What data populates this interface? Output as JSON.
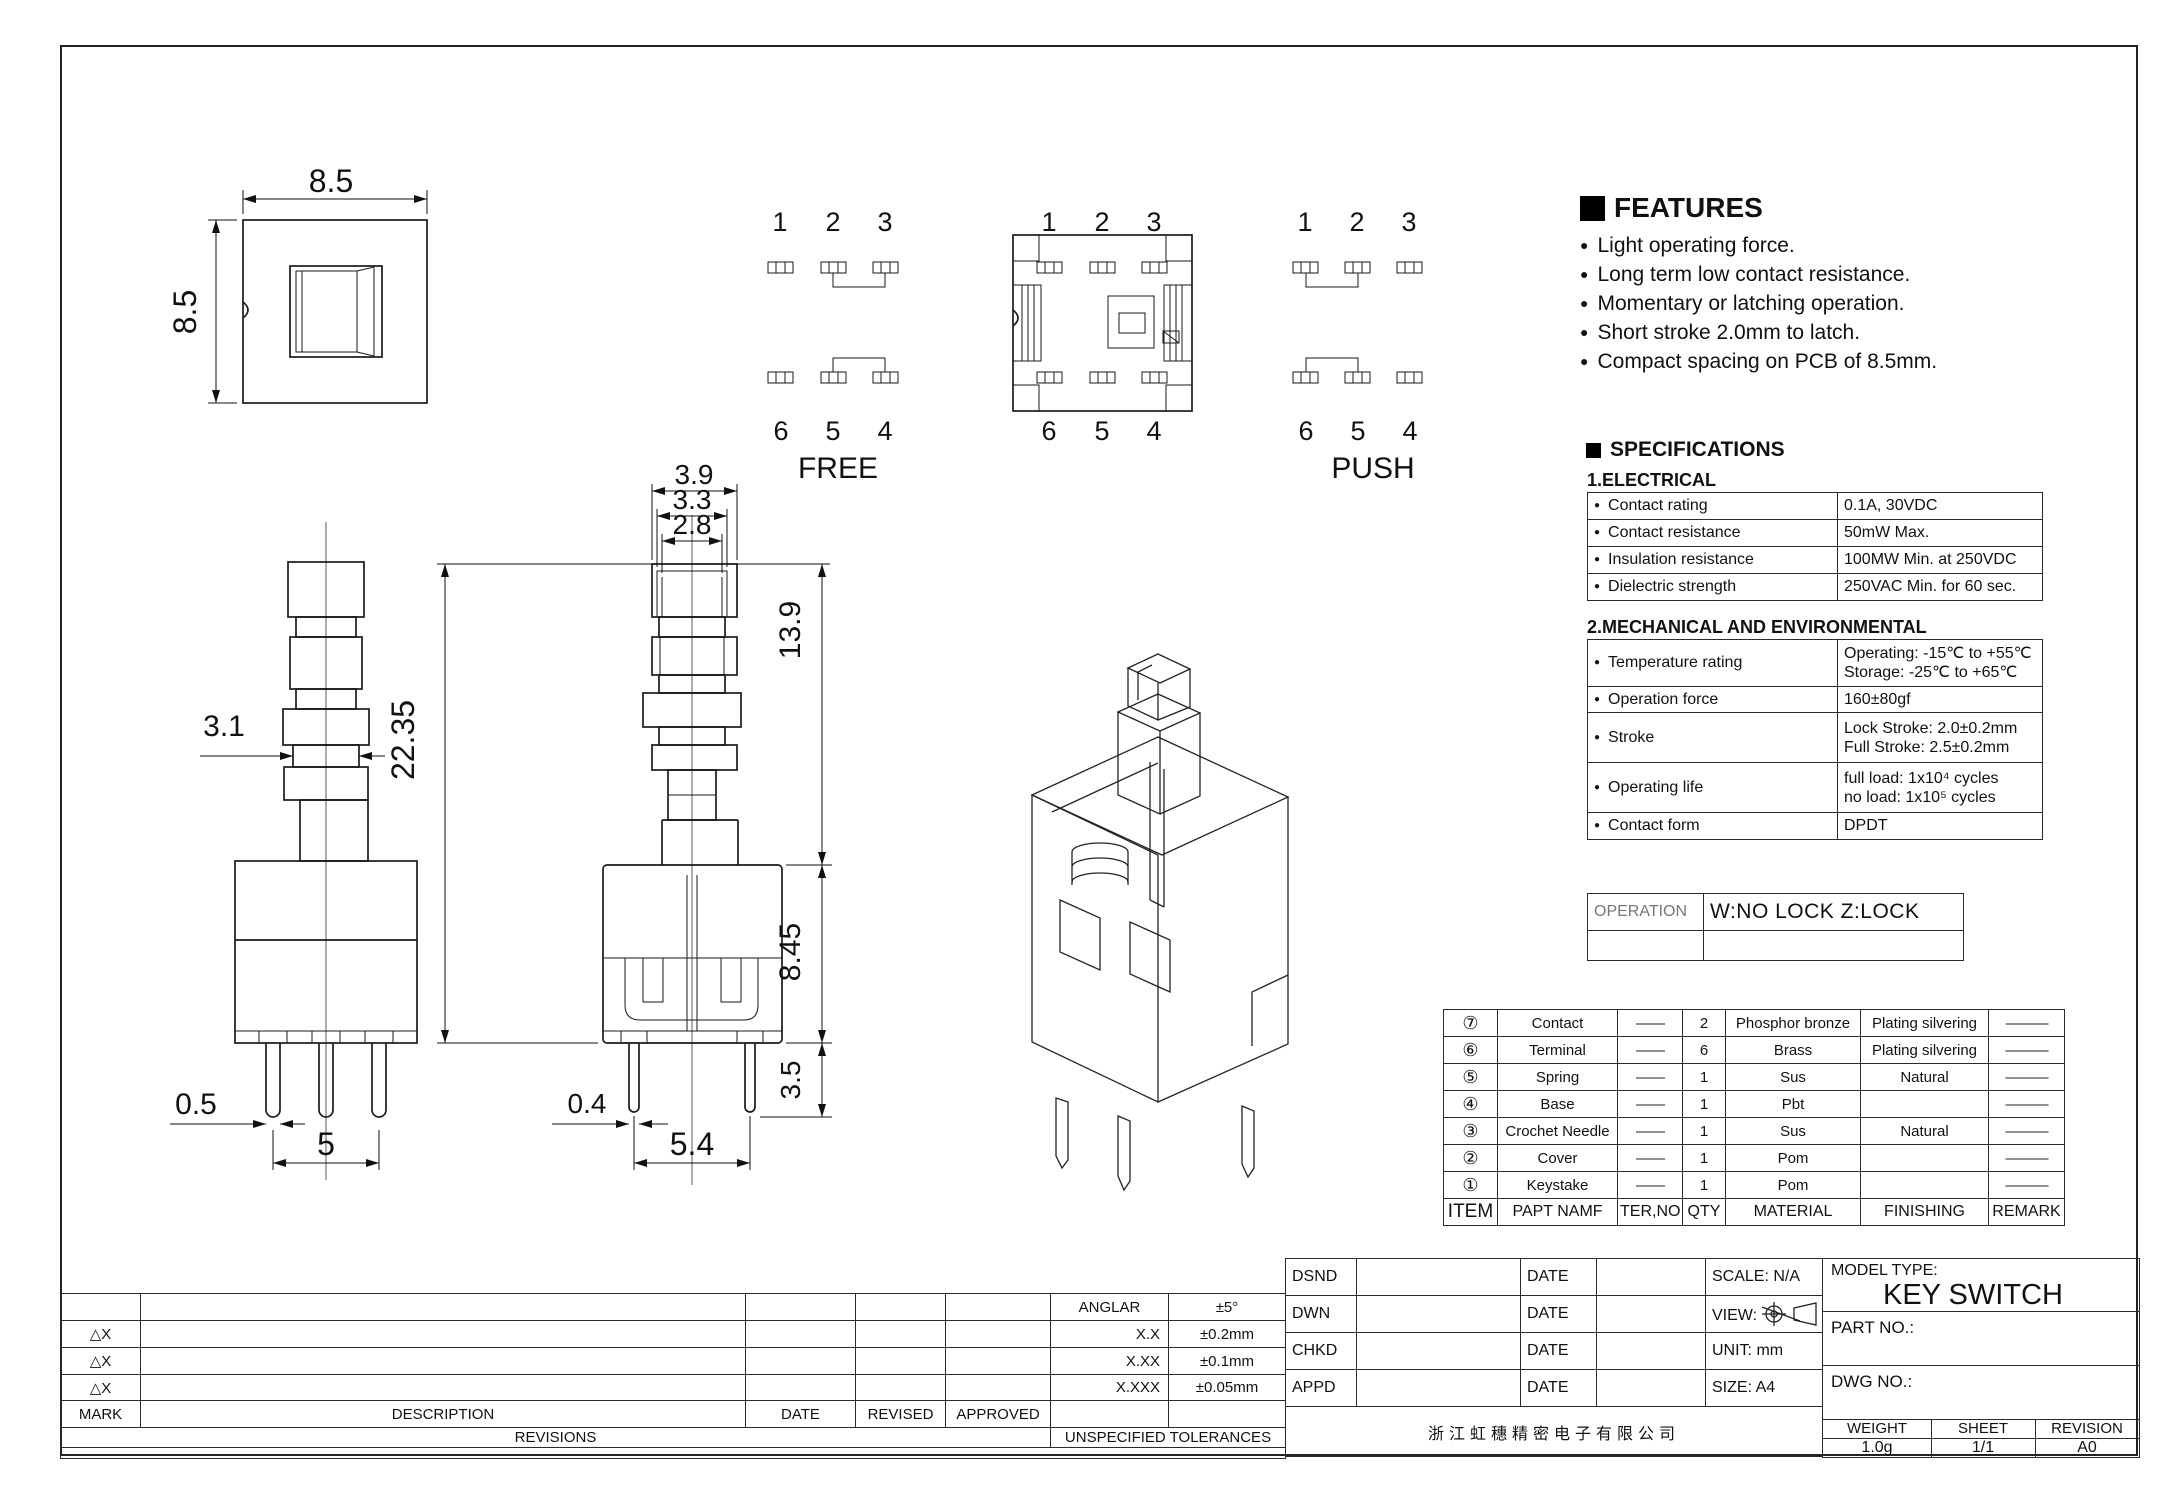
{
  "drawing": {
    "small_front": {
      "dim_width": "8.5",
      "dim_height": "8.5"
    },
    "circuit_free": {
      "label": "FREE",
      "top_pins": [
        "1",
        "2",
        "3"
      ],
      "bottom_pins": [
        "6",
        "5",
        "4"
      ]
    },
    "top_view": {
      "top_pins": [
        "1",
        "2",
        "3"
      ],
      "bottom_pins": [
        "6",
        "5",
        "4"
      ]
    },
    "circuit_push": {
      "label": "PUSH",
      "top_pins": [
        "1",
        "2",
        "3"
      ],
      "bottom_pins": [
        "6",
        "5",
        "4"
      ]
    },
    "side_view": {
      "dim_neck": "3.1",
      "dim_pin_width": "0.5",
      "dim_pin_pitch": "5"
    },
    "front_view": {
      "dim_cap": "3.9",
      "dim_cap_mid": "3.3",
      "dim_cap_inner": "2.8",
      "dim_total_height": "22.35",
      "dim_plunger_height": "13.9",
      "dim_body_height": "8.45",
      "dim_pin_length": "3.5",
      "dim_pin_width": "0.4",
      "dim_pin_pitch": "5.4"
    }
  },
  "features": {
    "title": "FEATURES",
    "items": [
      "Light operating force.",
      "Long term low contact resistance.",
      "Momentary or latching operation.",
      "Short stroke 2.0mm to latch.",
      "Compact spacing on PCB of  8.5mm."
    ]
  },
  "specifications": {
    "title": "SPECIFICATIONS",
    "electrical_title": "1.ELECTRICAL",
    "electrical": [
      {
        "label": "Contact rating",
        "value": "0.1A, 30VDC"
      },
      {
        "label": "Contact resistance",
        "value": "50mW Max."
      },
      {
        "label": "Insulation resistance",
        "value": "100MW Min. at 250VDC"
      },
      {
        "label": "Dielectric strength",
        "value": "250VAC Min. for 60 sec."
      }
    ],
    "mechanical_title": "2.MECHANICAL AND ENVIRONMENTAL",
    "mechanical": [
      {
        "label": "Temperature rating",
        "line1": "Operating: -15℃ to +55℃",
        "line2": "Storage: -25℃ to +65℃"
      },
      {
        "label": "Operation force",
        "line1": "160±80gf",
        "line2": ""
      },
      {
        "label": "Stroke",
        "line1": "Lock Stroke: 2.0±0.2mm",
        "line2": "Full Stroke: 2.5±0.2mm"
      },
      {
        "label": "Operating life",
        "line1": "full load: 1x10⁴ cycles",
        "line2": "no load: 1x10⁵ cycles"
      },
      {
        "label": "Contact form",
        "line1": "DPDT",
        "line2": ""
      }
    ]
  },
  "operation": {
    "label": "OPERATION",
    "value": "W:NO LOCK Z:LOCK"
  },
  "bom": {
    "headers": [
      "ITEM",
      "PAPT NAMF",
      "TER,NO",
      "QTY",
      "MATERIAL",
      "FINISHING",
      "REMARK"
    ],
    "rows": [
      {
        "item": "⑦",
        "name": "Contact",
        "ter": "——",
        "qty": "2",
        "material": "Phosphor bronze",
        "finishing": "Plating silvering",
        "remark": "———"
      },
      {
        "item": "⑥",
        "name": "Terminal",
        "ter": "——",
        "qty": "6",
        "material": "Brass",
        "finishing": "Plating silvering",
        "remark": "———"
      },
      {
        "item": "⑤",
        "name": "Spring",
        "ter": "——",
        "qty": "1",
        "material": "Sus",
        "finishing": "Natural",
        "remark": "———"
      },
      {
        "item": "④",
        "name": "Base",
        "ter": "——",
        "qty": "1",
        "material": "Pbt",
        "finishing": "",
        "remark": "———"
      },
      {
        "item": "③",
        "name": "Crochet Needle",
        "ter": "——",
        "qty": "1",
        "material": "Sus",
        "finishing": "Natural",
        "remark": "———"
      },
      {
        "item": "②",
        "name": "Cover",
        "ter": "——",
        "qty": "1",
        "material": "Pom",
        "finishing": "",
        "remark": "———"
      },
      {
        "item": "①",
        "name": "Keystake",
        "ter": "——",
        "qty": "1",
        "material": "Pom",
        "finishing": "",
        "remark": "———"
      }
    ]
  },
  "revisions": {
    "title": "REVISIONS",
    "mark_rows": [
      "△X",
      "△X",
      "△X"
    ],
    "headers": {
      "mark": "MARK",
      "description": "DESCRIPTION",
      "date": "DATE",
      "revised": "REVISED",
      "approved": "APPROVED"
    }
  },
  "tolerances": {
    "title": "UNSPECIFIED TOLERANCES",
    "rows": [
      {
        "label": "ANGLAR",
        "value": "±5°"
      },
      {
        "label": "X.X",
        "value": "±0.2mm"
      },
      {
        "label": "X.XX",
        "value": "±0.1mm"
      },
      {
        "label": "X.XXX",
        "value": "±0.05mm"
      }
    ]
  },
  "title_block": {
    "rows": [
      {
        "role": "DSND",
        "date": "DATE"
      },
      {
        "role": "DWN",
        "date": "DATE"
      },
      {
        "role": "CHKD",
        "date": "DATE"
      },
      {
        "role": "APPD",
        "date": "DATE"
      }
    ],
    "scale": "SCALE: N/A",
    "view": "VIEW:",
    "unit": "UNIT: mm",
    "size": "SIZE: A4",
    "model_type_label": "MODEL TYPE:",
    "model_type": "KEY SWITCH",
    "part_no_label": "PART NO.:",
    "dwg_no_label": "DWG NO.:",
    "weight_label": "WEIGHT",
    "weight": "1.0g",
    "sheet_label": "SHEET",
    "sheet": "1/1",
    "revision_label": "REVISION",
    "revision": "A0",
    "company": "浙江虹穗精密电子有限公司"
  }
}
